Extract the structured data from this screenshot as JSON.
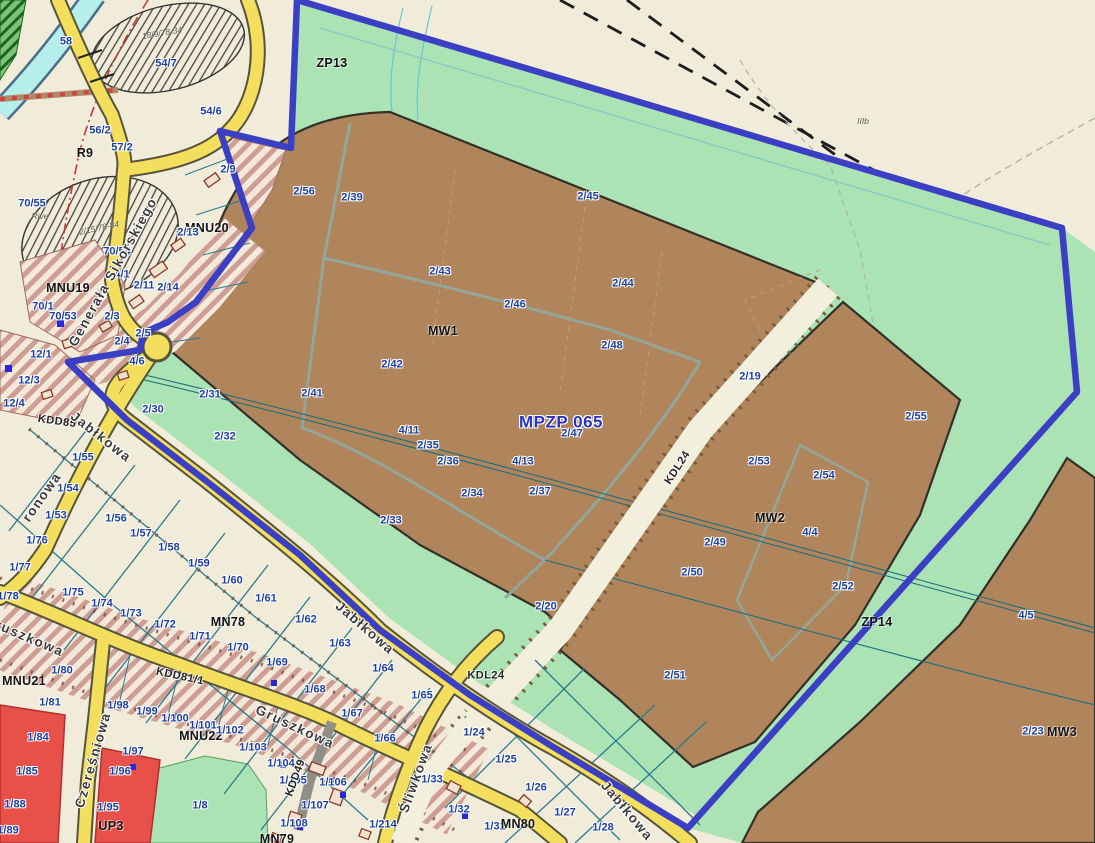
{
  "map": {
    "plan_id": "MPZP 065",
    "type": "municipal zoning plan (miejscowy plan zagospodarowania przestrzennego)"
  },
  "palette": {
    "base_cream": "#f0ecd9",
    "zone_brown_mw": "#b0855b",
    "zone_green_zp": "#abe3b4",
    "zone_red_up": "#e8514a",
    "hatch_mnu_stripe": "#cf9e92",
    "road_yellow": "#f4de5e",
    "road_gray": "#9b9b94",
    "road_kdl_cream": "#f2efdc",
    "plan_boundary_blue": "#3a3fc4",
    "river_cyan": "#b5eeea",
    "parcel_line_teal": "#2b7a8c",
    "parcel_label_blue": "#1d3fa3"
  },
  "labels": [
    {
      "t": "58",
      "x": 66,
      "y": 42,
      "c": "p"
    },
    {
      "t": "54/7",
      "x": 166,
      "y": 64,
      "c": "p"
    },
    {
      "t": "18/9/78-34",
      "x": 162,
      "y": 33,
      "c": "a",
      "r": -10
    },
    {
      "t": "54/6",
      "x": 211,
      "y": 112,
      "c": "p"
    },
    {
      "t": "56/2",
      "x": 100,
      "y": 131,
      "c": "p"
    },
    {
      "t": "57/2",
      "x": 122,
      "y": 148,
      "c": "p"
    },
    {
      "t": "R9",
      "x": 85,
      "y": 153,
      "c": "z"
    },
    {
      "t": "2/9",
      "x": 228,
      "y": 170,
      "c": "p"
    },
    {
      "t": "70/55",
      "x": 32,
      "y": 204,
      "c": "p"
    },
    {
      "t": "Rive",
      "x": 40,
      "y": 216,
      "c": "a"
    },
    {
      "t": "2/15/78-84",
      "x": 99,
      "y": 228,
      "c": "a",
      "r": -12
    },
    {
      "t": "MNU20",
      "x": 207,
      "y": 228,
      "c": "z"
    },
    {
      "t": "2/13",
      "x": 188,
      "y": 233,
      "c": "p"
    },
    {
      "t": "70/54",
      "x": 117,
      "y": 252,
      "c": "p"
    },
    {
      "t": "4/1",
      "x": 122,
      "y": 275,
      "c": "p"
    },
    {
      "t": "MNU19",
      "x": 68,
      "y": 288,
      "c": "z"
    },
    {
      "t": "2/11",
      "x": 144,
      "y": 286,
      "c": "p"
    },
    {
      "t": "2/14",
      "x": 168,
      "y": 288,
      "c": "p"
    },
    {
      "t": "70/1",
      "x": 43,
      "y": 307,
      "c": "p"
    },
    {
      "t": "70/53",
      "x": 63,
      "y": 317,
      "c": "p"
    },
    {
      "t": "2/3",
      "x": 112,
      "y": 317,
      "c": "p"
    },
    {
      "t": "2/5",
      "x": 143,
      "y": 334,
      "c": "p"
    },
    {
      "t": "2/4",
      "x": 122,
      "y": 342,
      "c": "p"
    },
    {
      "t": "12/1",
      "x": 41,
      "y": 355,
      "c": "p"
    },
    {
      "t": "12/3",
      "x": 29,
      "y": 381,
      "c": "p"
    },
    {
      "t": "12/4",
      "x": 14,
      "y": 404,
      "c": "p"
    },
    {
      "t": "4/6",
      "x": 137,
      "y": 362,
      "c": "p"
    },
    {
      "t": "2/30",
      "x": 153,
      "y": 410,
      "c": "p"
    },
    {
      "t": "2/31",
      "x": 210,
      "y": 395,
      "c": "p"
    },
    {
      "t": "2/32",
      "x": 225,
      "y": 437,
      "c": "p"
    },
    {
      "t": "KDD85",
      "x": 57,
      "y": 422,
      "c": "rc",
      "r": 8
    },
    {
      "t": "Jabłkowa",
      "x": 101,
      "y": 437,
      "c": "s",
      "r": 38
    },
    {
      "t": "Generała Sikorskiego",
      "x": 113,
      "y": 272,
      "c": "s",
      "r": -61
    },
    {
      "t": "ronowa",
      "x": 42,
      "y": 497,
      "c": "s",
      "r": -55
    },
    {
      "t": "ZP13",
      "x": 332,
      "y": 63,
      "c": "z"
    },
    {
      "t": "IIIb",
      "x": 863,
      "y": 121,
      "c": "a"
    },
    {
      "t": "2/56",
      "x": 304,
      "y": 192,
      "c": "p"
    },
    {
      "t": "2/39",
      "x": 352,
      "y": 198,
      "c": "p"
    },
    {
      "t": "2/45",
      "x": 588,
      "y": 197,
      "c": "p"
    },
    {
      "t": "2/43",
      "x": 440,
      "y": 272,
      "c": "p"
    },
    {
      "t": "2/44",
      "x": 623,
      "y": 284,
      "c": "p"
    },
    {
      "t": "2/46",
      "x": 515,
      "y": 305,
      "c": "p"
    },
    {
      "t": "MW1",
      "x": 443,
      "y": 331,
      "c": "z"
    },
    {
      "t": "2/48",
      "x": 612,
      "y": 346,
      "c": "p"
    },
    {
      "t": "2/42",
      "x": 392,
      "y": 365,
      "c": "p"
    },
    {
      "t": "2/41",
      "x": 312,
      "y": 394,
      "c": "p"
    },
    {
      "t": "2/19",
      "x": 750,
      "y": 377,
      "c": "p"
    },
    {
      "t": "MPZP 065",
      "x": 561,
      "y": 422,
      "c": "pl"
    },
    {
      "t": "2/47",
      "x": 572,
      "y": 434,
      "c": "p"
    },
    {
      "t": "4/11",
      "x": 409,
      "y": 431,
      "c": "p"
    },
    {
      "t": "2/35",
      "x": 428,
      "y": 446,
      "c": "p"
    },
    {
      "t": "2/36",
      "x": 448,
      "y": 462,
      "c": "p"
    },
    {
      "t": "4/13",
      "x": 523,
      "y": 462,
      "c": "p"
    },
    {
      "t": "2/34",
      "x": 472,
      "y": 494,
      "c": "p"
    },
    {
      "t": "2/37",
      "x": 540,
      "y": 492,
      "c": "p"
    },
    {
      "t": "2/33",
      "x": 391,
      "y": 521,
      "c": "p"
    },
    {
      "t": "KDL24",
      "x": 678,
      "y": 468,
      "c": "rc",
      "r": -57
    },
    {
      "t": "2/55",
      "x": 916,
      "y": 417,
      "c": "p"
    },
    {
      "t": "2/53",
      "x": 759,
      "y": 462,
      "c": "p"
    },
    {
      "t": "2/54",
      "x": 824,
      "y": 476,
      "c": "p"
    },
    {
      "t": "MW2",
      "x": 770,
      "y": 518,
      "c": "z"
    },
    {
      "t": "4/4",
      "x": 810,
      "y": 533,
      "c": "p"
    },
    {
      "t": "2/49",
      "x": 715,
      "y": 543,
      "c": "p"
    },
    {
      "t": "2/50",
      "x": 692,
      "y": 573,
      "c": "p"
    },
    {
      "t": "2/52",
      "x": 843,
      "y": 587,
      "c": "p"
    },
    {
      "t": "ZP14",
      "x": 877,
      "y": 622,
      "c": "z"
    },
    {
      "t": "4/5",
      "x": 1026,
      "y": 616,
      "c": "p"
    },
    {
      "t": "2/20",
      "x": 546,
      "y": 607,
      "c": "p"
    },
    {
      "t": "2/51",
      "x": 675,
      "y": 676,
      "c": "p"
    },
    {
      "t": "2/23",
      "x": 1033,
      "y": 732,
      "c": "p"
    },
    {
      "t": "MW3",
      "x": 1062,
      "y": 732,
      "c": "z"
    },
    {
      "t": "1/55",
      "x": 83,
      "y": 458,
      "c": "p"
    },
    {
      "t": "1/54",
      "x": 68,
      "y": 489,
      "c": "p"
    },
    {
      "t": "1/53",
      "x": 56,
      "y": 516,
      "c": "p"
    },
    {
      "t": "1/76",
      "x": 37,
      "y": 541,
      "c": "p"
    },
    {
      "t": "1/56",
      "x": 116,
      "y": 519,
      "c": "p"
    },
    {
      "t": "1/57",
      "x": 141,
      "y": 534,
      "c": "p"
    },
    {
      "t": "1/58",
      "x": 169,
      "y": 548,
      "c": "p"
    },
    {
      "t": "1/59",
      "x": 199,
      "y": 564,
      "c": "p"
    },
    {
      "t": "1/60",
      "x": 232,
      "y": 581,
      "c": "p"
    },
    {
      "t": "1/61",
      "x": 266,
      "y": 599,
      "c": "p"
    },
    {
      "t": "1/62",
      "x": 306,
      "y": 620,
      "c": "p"
    },
    {
      "t": "1/77",
      "x": 20,
      "y": 568,
      "c": "p"
    },
    {
      "t": "1/78",
      "x": 8,
      "y": 597,
      "c": "p"
    },
    {
      "t": "1/75",
      "x": 73,
      "y": 593,
      "c": "p"
    },
    {
      "t": "1/74",
      "x": 102,
      "y": 604,
      "c": "p"
    },
    {
      "t": "1/73",
      "x": 131,
      "y": 614,
      "c": "p"
    },
    {
      "t": "1/72",
      "x": 165,
      "y": 625,
      "c": "p"
    },
    {
      "t": "1/71",
      "x": 200,
      "y": 637,
      "c": "p"
    },
    {
      "t": "1/70",
      "x": 238,
      "y": 648,
      "c": "p"
    },
    {
      "t": "1/69",
      "x": 277,
      "y": 663,
      "c": "p"
    },
    {
      "t": "1/68",
      "x": 315,
      "y": 690,
      "c": "p"
    },
    {
      "t": "1/67",
      "x": 352,
      "y": 714,
      "c": "p"
    },
    {
      "t": "1/66",
      "x": 385,
      "y": 739,
      "c": "p"
    },
    {
      "t": "1/63",
      "x": 340,
      "y": 644,
      "c": "p"
    },
    {
      "t": "1/64",
      "x": 383,
      "y": 669,
      "c": "p"
    },
    {
      "t": "1/65",
      "x": 422,
      "y": 696,
      "c": "p"
    },
    {
      "t": "MN78",
      "x": 228,
      "y": 622,
      "c": "z"
    },
    {
      "t": "Jabłkowa",
      "x": 365,
      "y": 628,
      "c": "s",
      "r": 41
    },
    {
      "t": "Gruszkowa",
      "x": 24,
      "y": 636,
      "c": "s",
      "r": 23
    },
    {
      "t": "Gruszkowa",
      "x": 295,
      "y": 727,
      "c": "s",
      "r": 25
    },
    {
      "t": "KDD81/1",
      "x": 180,
      "y": 677,
      "c": "rc",
      "r": 12
    },
    {
      "t": "MNU21",
      "x": 24,
      "y": 681,
      "c": "z"
    },
    {
      "t": "1/80",
      "x": 62,
      "y": 671,
      "c": "p"
    },
    {
      "t": "1/81",
      "x": 50,
      "y": 703,
      "c": "p"
    },
    {
      "t": "1/98",
      "x": 118,
      "y": 706,
      "c": "p"
    },
    {
      "t": "1/99",
      "x": 147,
      "y": 712,
      "c": "p"
    },
    {
      "t": "1/100",
      "x": 175,
      "y": 719,
      "c": "p"
    },
    {
      "t": "1/101",
      "x": 203,
      "y": 726,
      "c": "p"
    },
    {
      "t": "MNU22",
      "x": 201,
      "y": 736,
      "c": "z"
    },
    {
      "t": "1/102",
      "x": 230,
      "y": 731,
      "c": "p"
    },
    {
      "t": "1/103",
      "x": 253,
      "y": 748,
      "c": "p"
    },
    {
      "t": "1/104",
      "x": 281,
      "y": 764,
      "c": "p"
    },
    {
      "t": "1/105",
      "x": 293,
      "y": 781,
      "c": "p"
    },
    {
      "t": "1/106",
      "x": 333,
      "y": 783,
      "c": "p"
    },
    {
      "t": "1/107",
      "x": 315,
      "y": 806,
      "c": "p"
    },
    {
      "t": "1/108",
      "x": 294,
      "y": 824,
      "c": "p"
    },
    {
      "t": "1/84",
      "x": 38,
      "y": 738,
      "c": "p"
    },
    {
      "t": "1/85",
      "x": 27,
      "y": 772,
      "c": "p"
    },
    {
      "t": "1/88",
      "x": 15,
      "y": 805,
      "c": "p"
    },
    {
      "t": "1/89",
      "x": 8,
      "y": 831,
      "c": "p"
    },
    {
      "t": "1/97",
      "x": 133,
      "y": 752,
      "c": "p"
    },
    {
      "t": "1/96",
      "x": 120,
      "y": 772,
      "c": "p"
    },
    {
      "t": "1/95",
      "x": 108,
      "y": 808,
      "c": "p"
    },
    {
      "t": "UP3",
      "x": 111,
      "y": 826,
      "c": "z"
    },
    {
      "t": "1/8",
      "x": 200,
      "y": 806,
      "c": "p"
    },
    {
      "t": "Czereśniowa",
      "x": 93,
      "y": 760,
      "c": "s",
      "r": -74
    },
    {
      "t": "KDD49",
      "x": 296,
      "y": 778,
      "c": "rc",
      "r": -70
    },
    {
      "t": "Śliwkowa",
      "x": 416,
      "y": 778,
      "c": "s",
      "r": -70
    },
    {
      "t": "MN79",
      "x": 277,
      "y": 839,
      "c": "z"
    },
    {
      "t": "1/214",
      "x": 383,
      "y": 825,
      "c": "p"
    },
    {
      "t": "KDL24",
      "x": 486,
      "y": 676,
      "c": "rc"
    },
    {
      "t": "1/24",
      "x": 474,
      "y": 733,
      "c": "p"
    },
    {
      "t": "1/25",
      "x": 506,
      "y": 760,
      "c": "p"
    },
    {
      "t": "1/26",
      "x": 536,
      "y": 788,
      "c": "p"
    },
    {
      "t": "1/33",
      "x": 432,
      "y": 780,
      "c": "p"
    },
    {
      "t": "1/32",
      "x": 459,
      "y": 810,
      "c": "p"
    },
    {
      "t": "1/27",
      "x": 565,
      "y": 813,
      "c": "p"
    },
    {
      "t": "1/31",
      "x": 495,
      "y": 827,
      "c": "p"
    },
    {
      "t": "1/28",
      "x": 603,
      "y": 828,
      "c": "p"
    },
    {
      "t": "MN80",
      "x": 518,
      "y": 824,
      "c": "z"
    },
    {
      "t": "Jabłkowa",
      "x": 627,
      "y": 811,
      "c": "s",
      "r": 50
    }
  ]
}
